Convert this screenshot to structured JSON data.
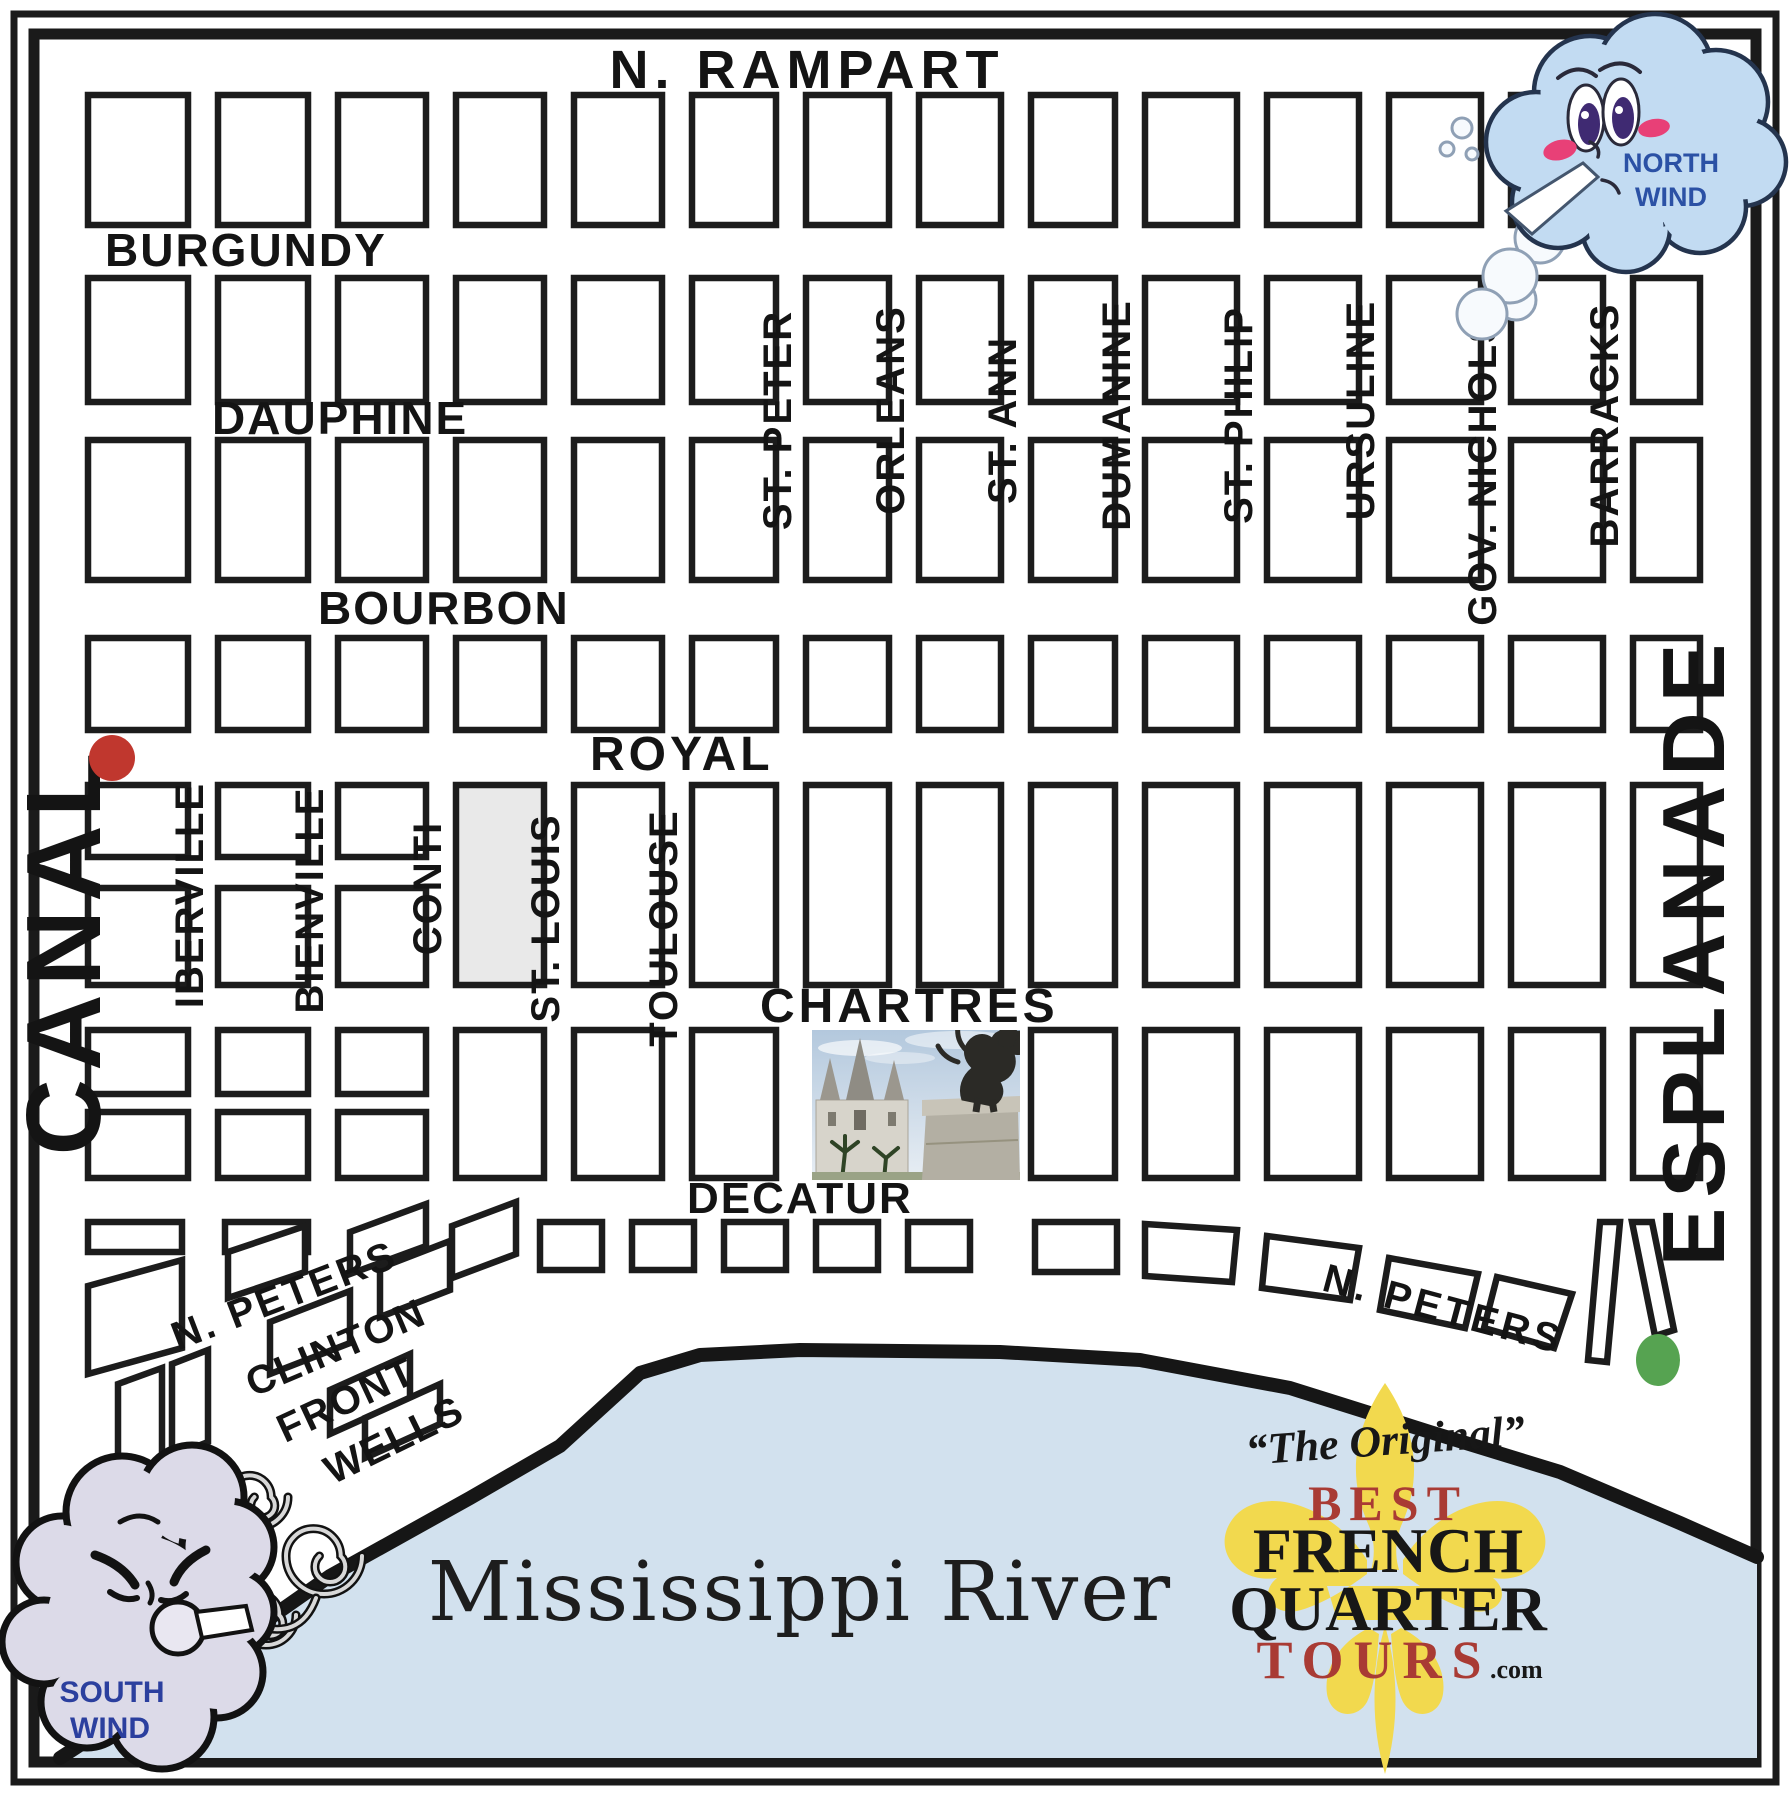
{
  "streets": {
    "n_rampart": "N. RAMPART",
    "burgundy": "BURGUNDY",
    "dauphine": "DAUPHINE",
    "bourbon": "BOURBON",
    "royal": "ROYAL",
    "chartres": "CHARTRES",
    "decatur": "DECATUR",
    "n_peters_left": "N. PETERS",
    "n_peters_right": "N. PETERS",
    "clinton": "CLINTON",
    "front": "FRONT",
    "wells": "WELLS",
    "canal": "CANAL",
    "esplanade": "ESPLANADE",
    "iberville": "IBERVILLE",
    "bienville": "BIENVILLE",
    "conti": "CONTI",
    "st_louis": "ST. LOUIS",
    "toulouse": "TOULOUSE",
    "st_peter": "ST. PETER",
    "orleans": "ORLEANS",
    "st_ann": "ST. ANN",
    "dumanine": "DUMANINE",
    "st_philip": "ST. PHILIP",
    "ursuline": "URSULINE",
    "gov_nichols": "GOV. NICHOLS",
    "barracks": "BARRACKS"
  },
  "river": {
    "label": "Mississippi River",
    "color": "#d2e1ee",
    "shore_color": "#161616"
  },
  "winds": {
    "north": {
      "line1": "NORTH",
      "line2": "WIND",
      "text_color": "#2b51a5",
      "cloud_color": "#c2dbf2"
    },
    "south": {
      "line1": "SOUTH",
      "line2": "WIND",
      "text_color": "#2b3f9e",
      "cloud_color": "#dcdae8"
    }
  },
  "logo": {
    "tagline": "“The Original”",
    "best": "BEST",
    "french": "FRENCH",
    "quarter": "QUARTER",
    "tours": "TOURS",
    "dotcom": ".com",
    "red": "#a93b34",
    "black": "#171717",
    "fleur_color": "#f2d94e"
  },
  "markers": {
    "canal_royal_dot_color": "#c0372e",
    "esplanade_dot_color": "#56a351"
  }
}
